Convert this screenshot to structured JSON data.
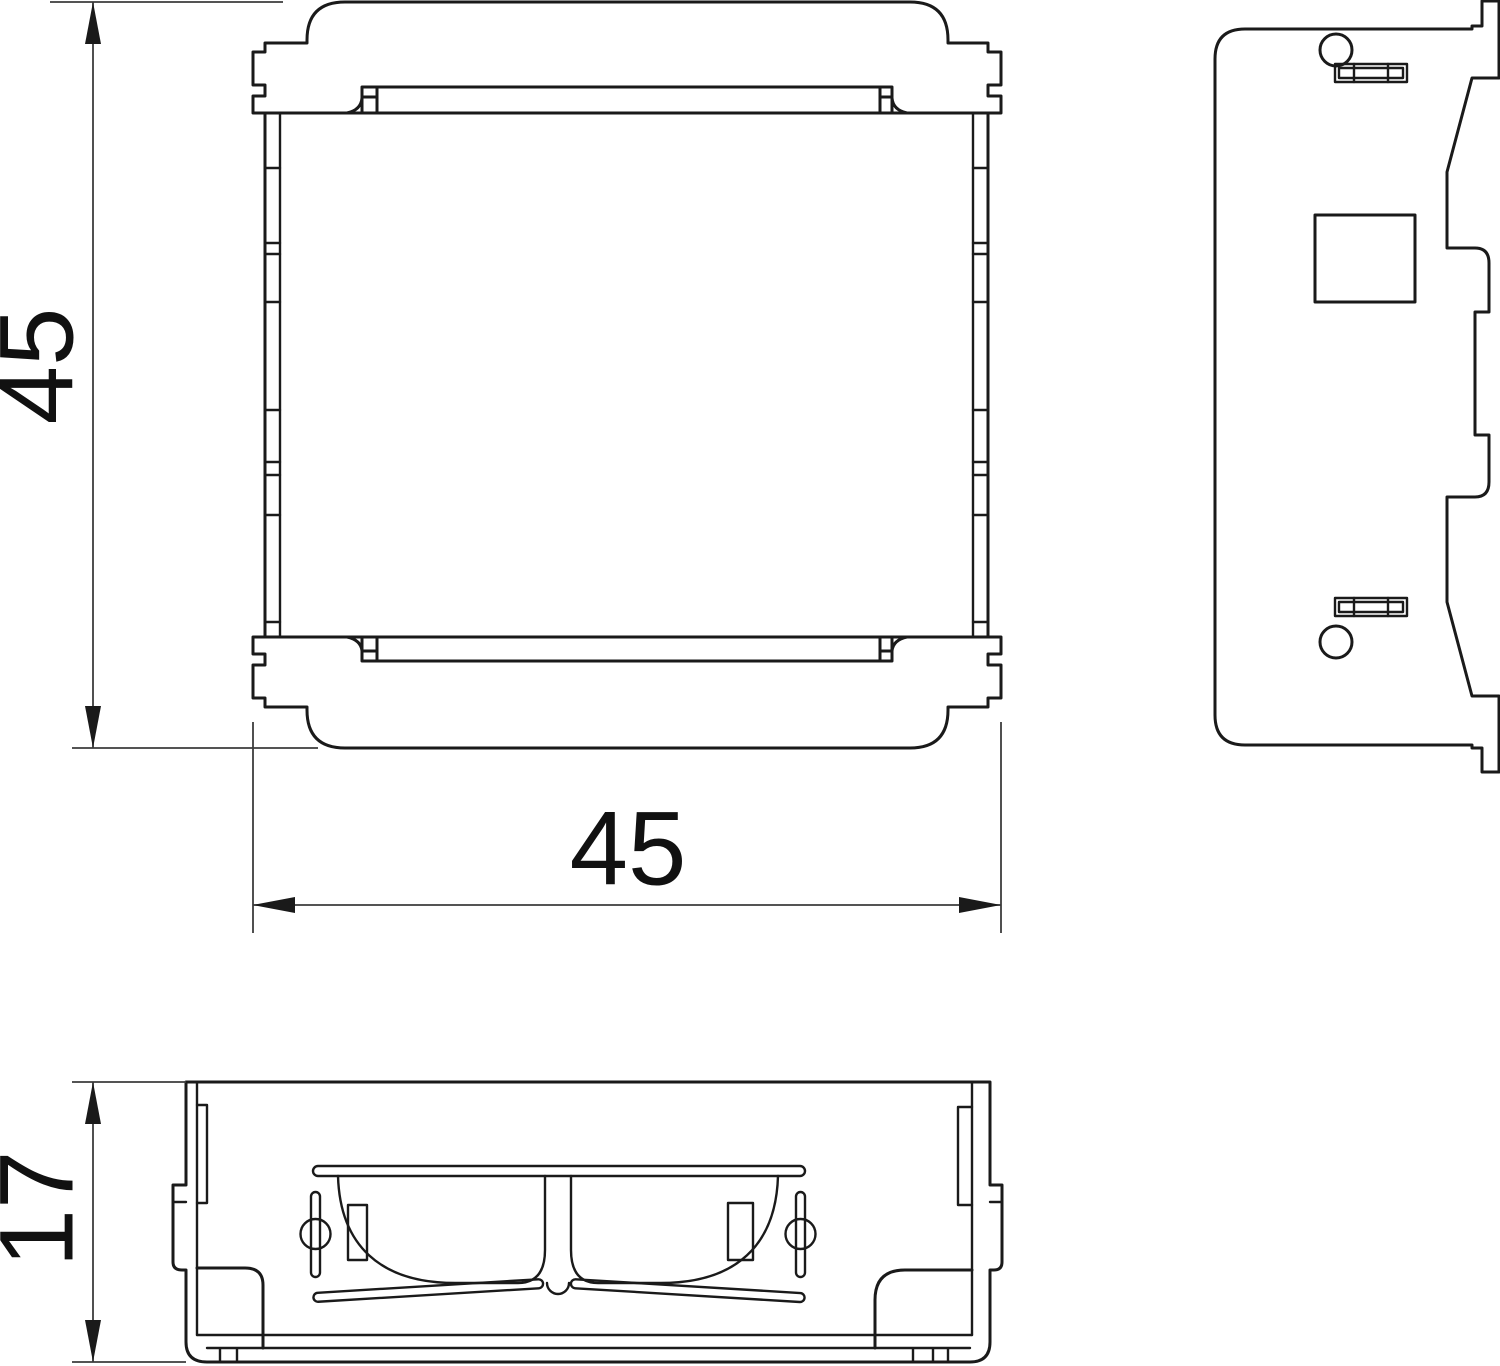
{
  "page": {
    "background_color": "#ffffff",
    "type": "technical-drawing"
  },
  "drawing": {
    "object_line_color": "#1a1a1a",
    "dimension_line_color": "#3c3c3c",
    "text_color": "#111111",
    "views": {
      "front": "front-view-45x45-module",
      "side": "side-view-module",
      "bottom": "bottom-view-module"
    },
    "dimensions": {
      "front_height": "45",
      "front_width": "45",
      "bottom_height": "17"
    }
  }
}
